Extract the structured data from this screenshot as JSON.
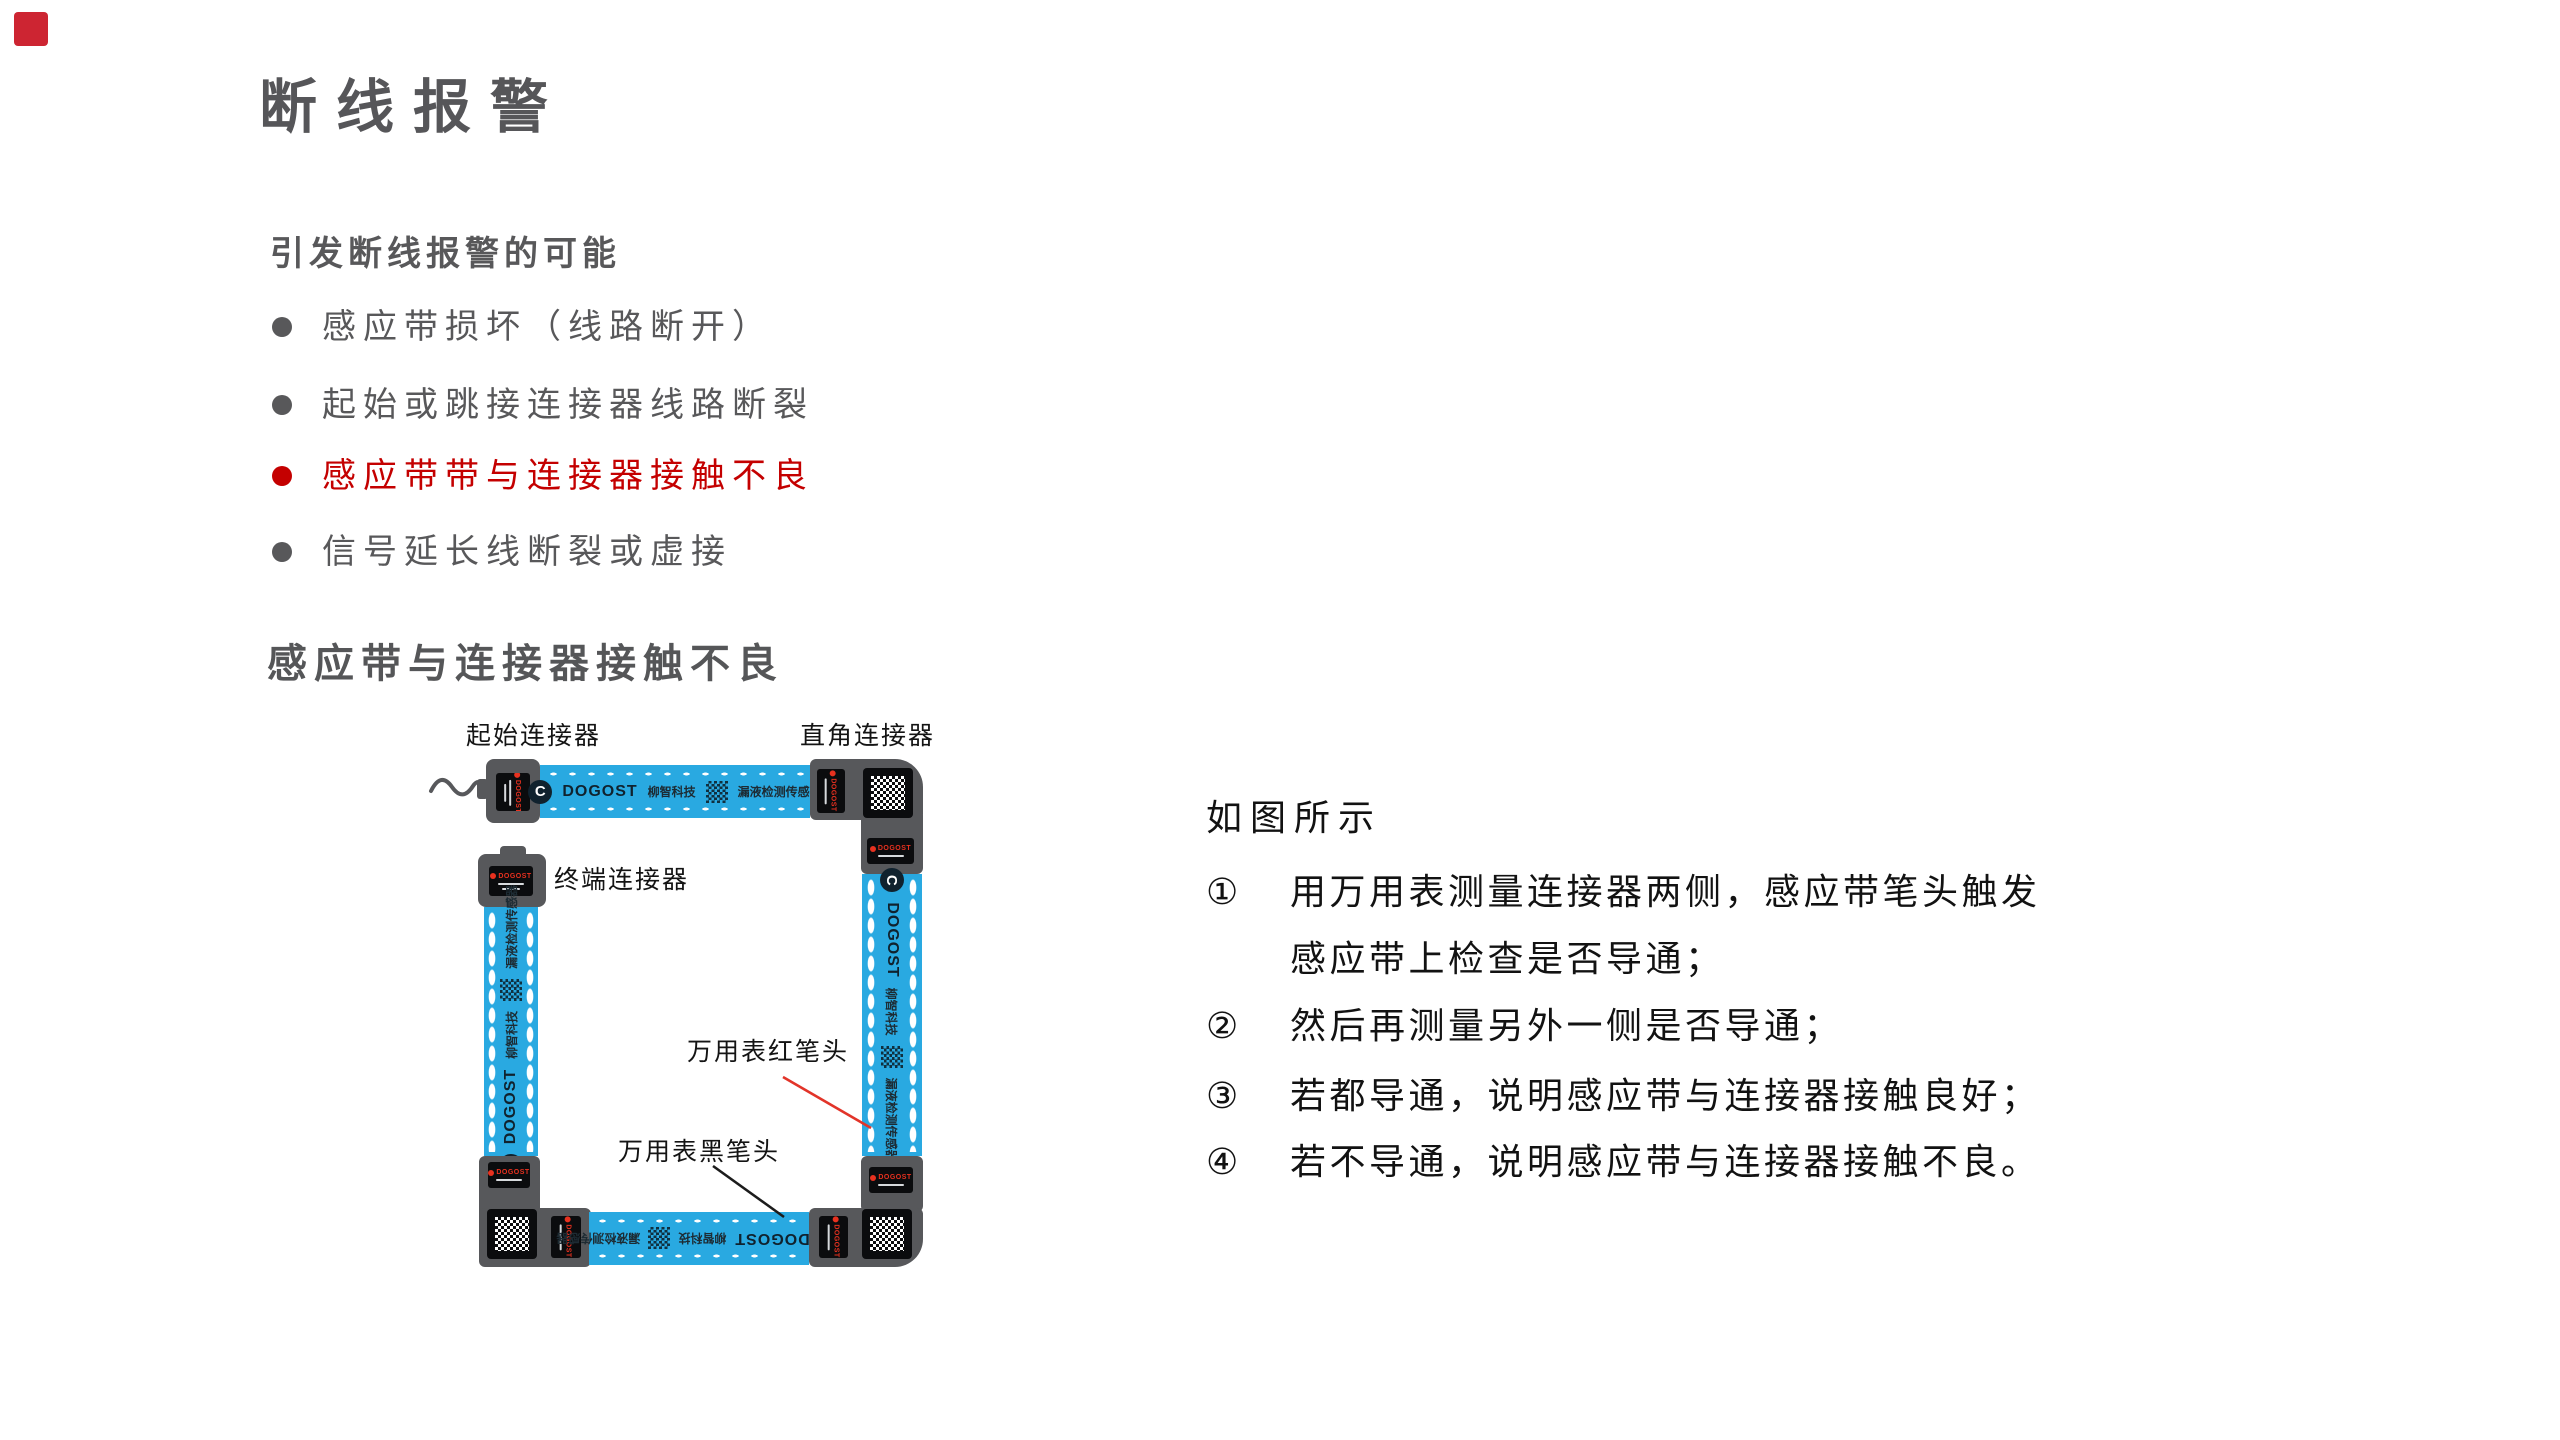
{
  "header": {
    "title": "断线报警",
    "logo_color": "#cd2532",
    "title_color": "#565659"
  },
  "causes": {
    "heading": "引发断线报警的可能",
    "text_color": "#58585a",
    "highlight_color": "#c40000",
    "items": [
      {
        "text": "感应带损坏（线路断开）",
        "highlight": false
      },
      {
        "text": "起始或跳接连接器线路断裂",
        "highlight": false
      },
      {
        "text": "感应带带与连接器接触不良",
        "highlight": true
      },
      {
        "text": "信号延长线断裂或虚接",
        "highlight": false
      }
    ]
  },
  "section": {
    "heading": "感应带与连接器接触不良"
  },
  "diagram": {
    "labels": {
      "start_connector": "起始连接器",
      "right_angle_connector": "直角连接器",
      "terminal_connector": "终端连接器",
      "multimeter_red_probe": "万用表红笔头",
      "multimeter_black_probe": "万用表黑笔头"
    },
    "tape_print": {
      "logo_letter": "C",
      "brand": "DOGOST",
      "company": "柳智科技",
      "product": "漏液检测传感器"
    },
    "colors": {
      "tape_blue": "#29a9e1",
      "connector_gray": "#57585b",
      "plate_black": "#0b0c0e",
      "brand_red": "#e8311f",
      "leader_red": "#e23429",
      "leader_black": "#1c1c1c"
    }
  },
  "instructions": {
    "intro": "如图所示",
    "steps": [
      {
        "num": "①",
        "lines": [
          "用万用表测量连接器两侧，感应带笔头触发",
          "感应带上检查是否导通；"
        ]
      },
      {
        "num": "②",
        "lines": [
          "然后再测量另外一侧是否导通；"
        ]
      },
      {
        "num": "③",
        "lines": [
          "若都导通，说明感应带与连接器接触良好；"
        ]
      },
      {
        "num": "④",
        "lines": [
          "若不导通，说明感应带与连接器接触不良。"
        ]
      }
    ]
  }
}
